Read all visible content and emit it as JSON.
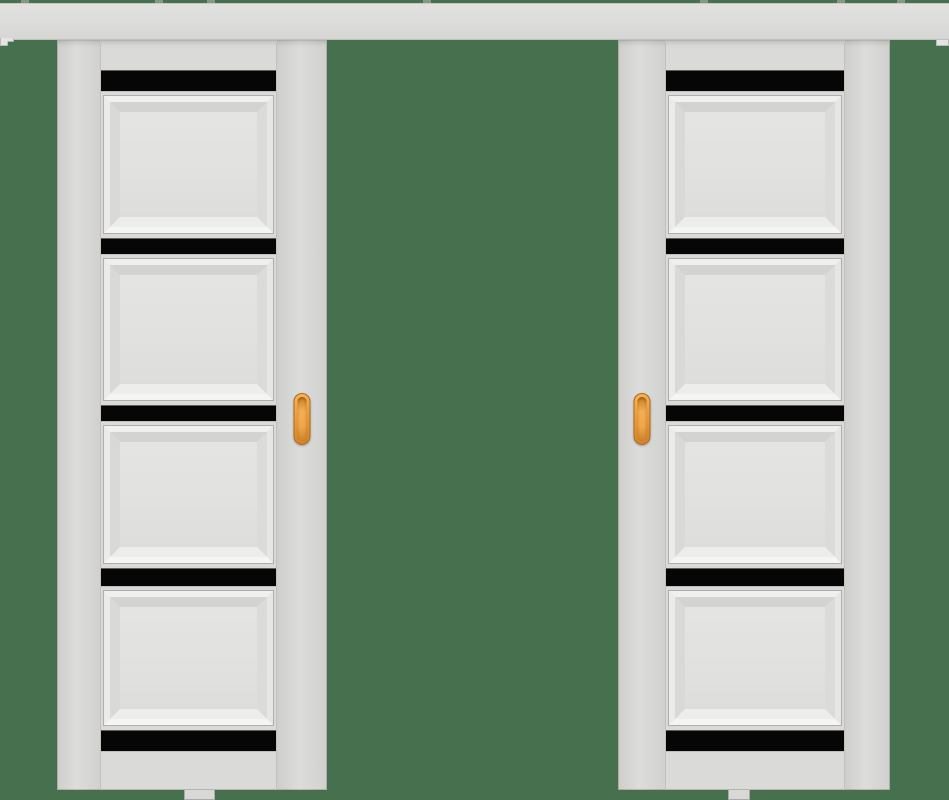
{
  "scene": {
    "description": "two white sliding pocket doors hanging from a full-width white top track on a green background",
    "palette": {
      "background": "#47714E",
      "track": "#DCDCDA",
      "door_face": "#DADAD8",
      "panel_field": "#E2E2E0",
      "glass_strip": "#060606",
      "edge_line": "#B0B0AE",
      "handle_orange": "#E99C3E",
      "handle_border": "#B06C1E"
    }
  },
  "track": {
    "x": 0,
    "y": 3,
    "width": 949,
    "height": 37,
    "bracket_positions": [
      21,
      155,
      207,
      423,
      700,
      837,
      897
    ],
    "end_caps": [
      "left",
      "right"
    ]
  },
  "door_rows": [
    {
      "type": "rail",
      "height": 30,
      "name": "door-top-rail"
    },
    {
      "type": "glass",
      "height": 22,
      "name": "glass-strip-1"
    },
    {
      "type": "panel",
      "height": 146,
      "name": "panel-1"
    },
    {
      "type": "glass",
      "height": 17,
      "name": "glass-strip-2"
    },
    {
      "type": "panel",
      "height": 150,
      "name": "panel-2"
    },
    {
      "type": "glass",
      "height": 17,
      "name": "glass-strip-3"
    },
    {
      "type": "panel",
      "height": 146,
      "name": "panel-3"
    },
    {
      "type": "glass",
      "height": 19,
      "name": "glass-strip-4"
    },
    {
      "type": "panel",
      "height": 143,
      "name": "panel-4"
    },
    {
      "type": "glass",
      "height": 22,
      "name": "glass-strip-5"
    },
    {
      "type": "rail",
      "height": 38,
      "name": "door-bottom-rail"
    }
  ],
  "doors": [
    {
      "name": "left-door",
      "x": 57,
      "width": 270,
      "top": 40,
      "height": 750,
      "handle_side": "right",
      "stile_outer_w": 43,
      "center_w": 177,
      "stile_handle_w": 50,
      "handle": {
        "w": 17,
        "h": 52,
        "top": 353
      },
      "guide": {
        "x": 127,
        "w": 31
      }
    },
    {
      "name": "right-door",
      "x": 618,
      "width": 272,
      "top": 40,
      "height": 750,
      "handle_side": "left",
      "stile_outer_w": 45,
      "center_w": 180,
      "stile_handle_w": 47,
      "handle": {
        "w": 17,
        "h": 52,
        "top": 353
      },
      "guide": {
        "x": 110,
        "w": 22
      }
    }
  ],
  "counts": {
    "doors": 2,
    "panels_per_door": 4,
    "glass_strips_per_door": 5,
    "handles_per_door": 1
  }
}
